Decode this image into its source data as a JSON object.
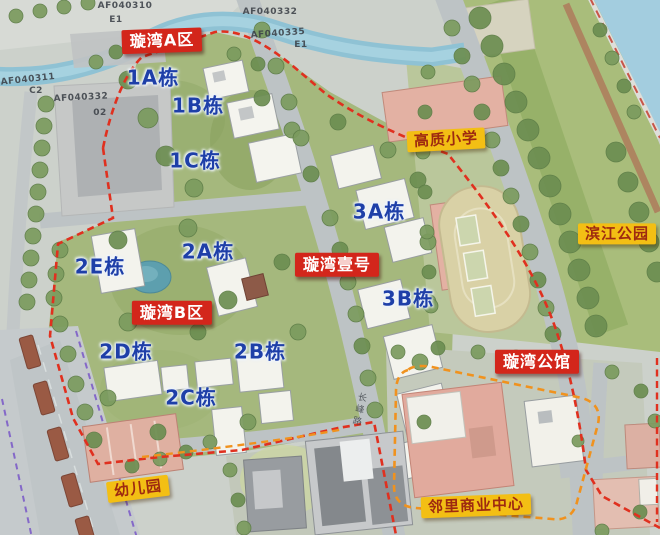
{
  "map": {
    "zones": {
      "zone_a": "璇湾A区",
      "zone_b": "璇湾B区",
      "yihao": "璇湾壹号",
      "gongguan": "璇湾公馆"
    },
    "pois": {
      "school": "高质小学",
      "park": "滨江公园",
      "kindergarten": "幼儿园",
      "commercial": "邻里商业中心"
    },
    "buildings": {
      "b1a": "1A栋",
      "b1b": "1B栋",
      "b1c": "1C栋",
      "b2a": "2A栋",
      "b2b": "2B栋",
      "b2c": "2C栋",
      "b2d": "2D栋",
      "b2e": "2E栋",
      "b3a": "3A栋",
      "b3b": "3B栋"
    },
    "parcel_codes": {
      "p310": "AF040310",
      "p310_sub": "E1",
      "p332_ne": "AF040332",
      "p335": "AF040335",
      "p335_sub": "E1",
      "p311": "AF040311",
      "p311_sub": "C2",
      "p332_w": "AF040332",
      "p332_w_sub": "02"
    },
    "roads": {
      "changfeng": "长峰路"
    },
    "colors": {
      "zone_label_bg": "#d3261b",
      "zone_label_text": "#ffffff",
      "poi_label_bg": "#f3bf14",
      "poi_label_text": "#9e2a10",
      "building_label": "#1e3fa8",
      "boundary_primary_red": "#e0301f",
      "boundary_secondary_orange": "#f0921e",
      "transit_dash_purple": "#8468c8",
      "water": "#92c3d6"
    }
  }
}
